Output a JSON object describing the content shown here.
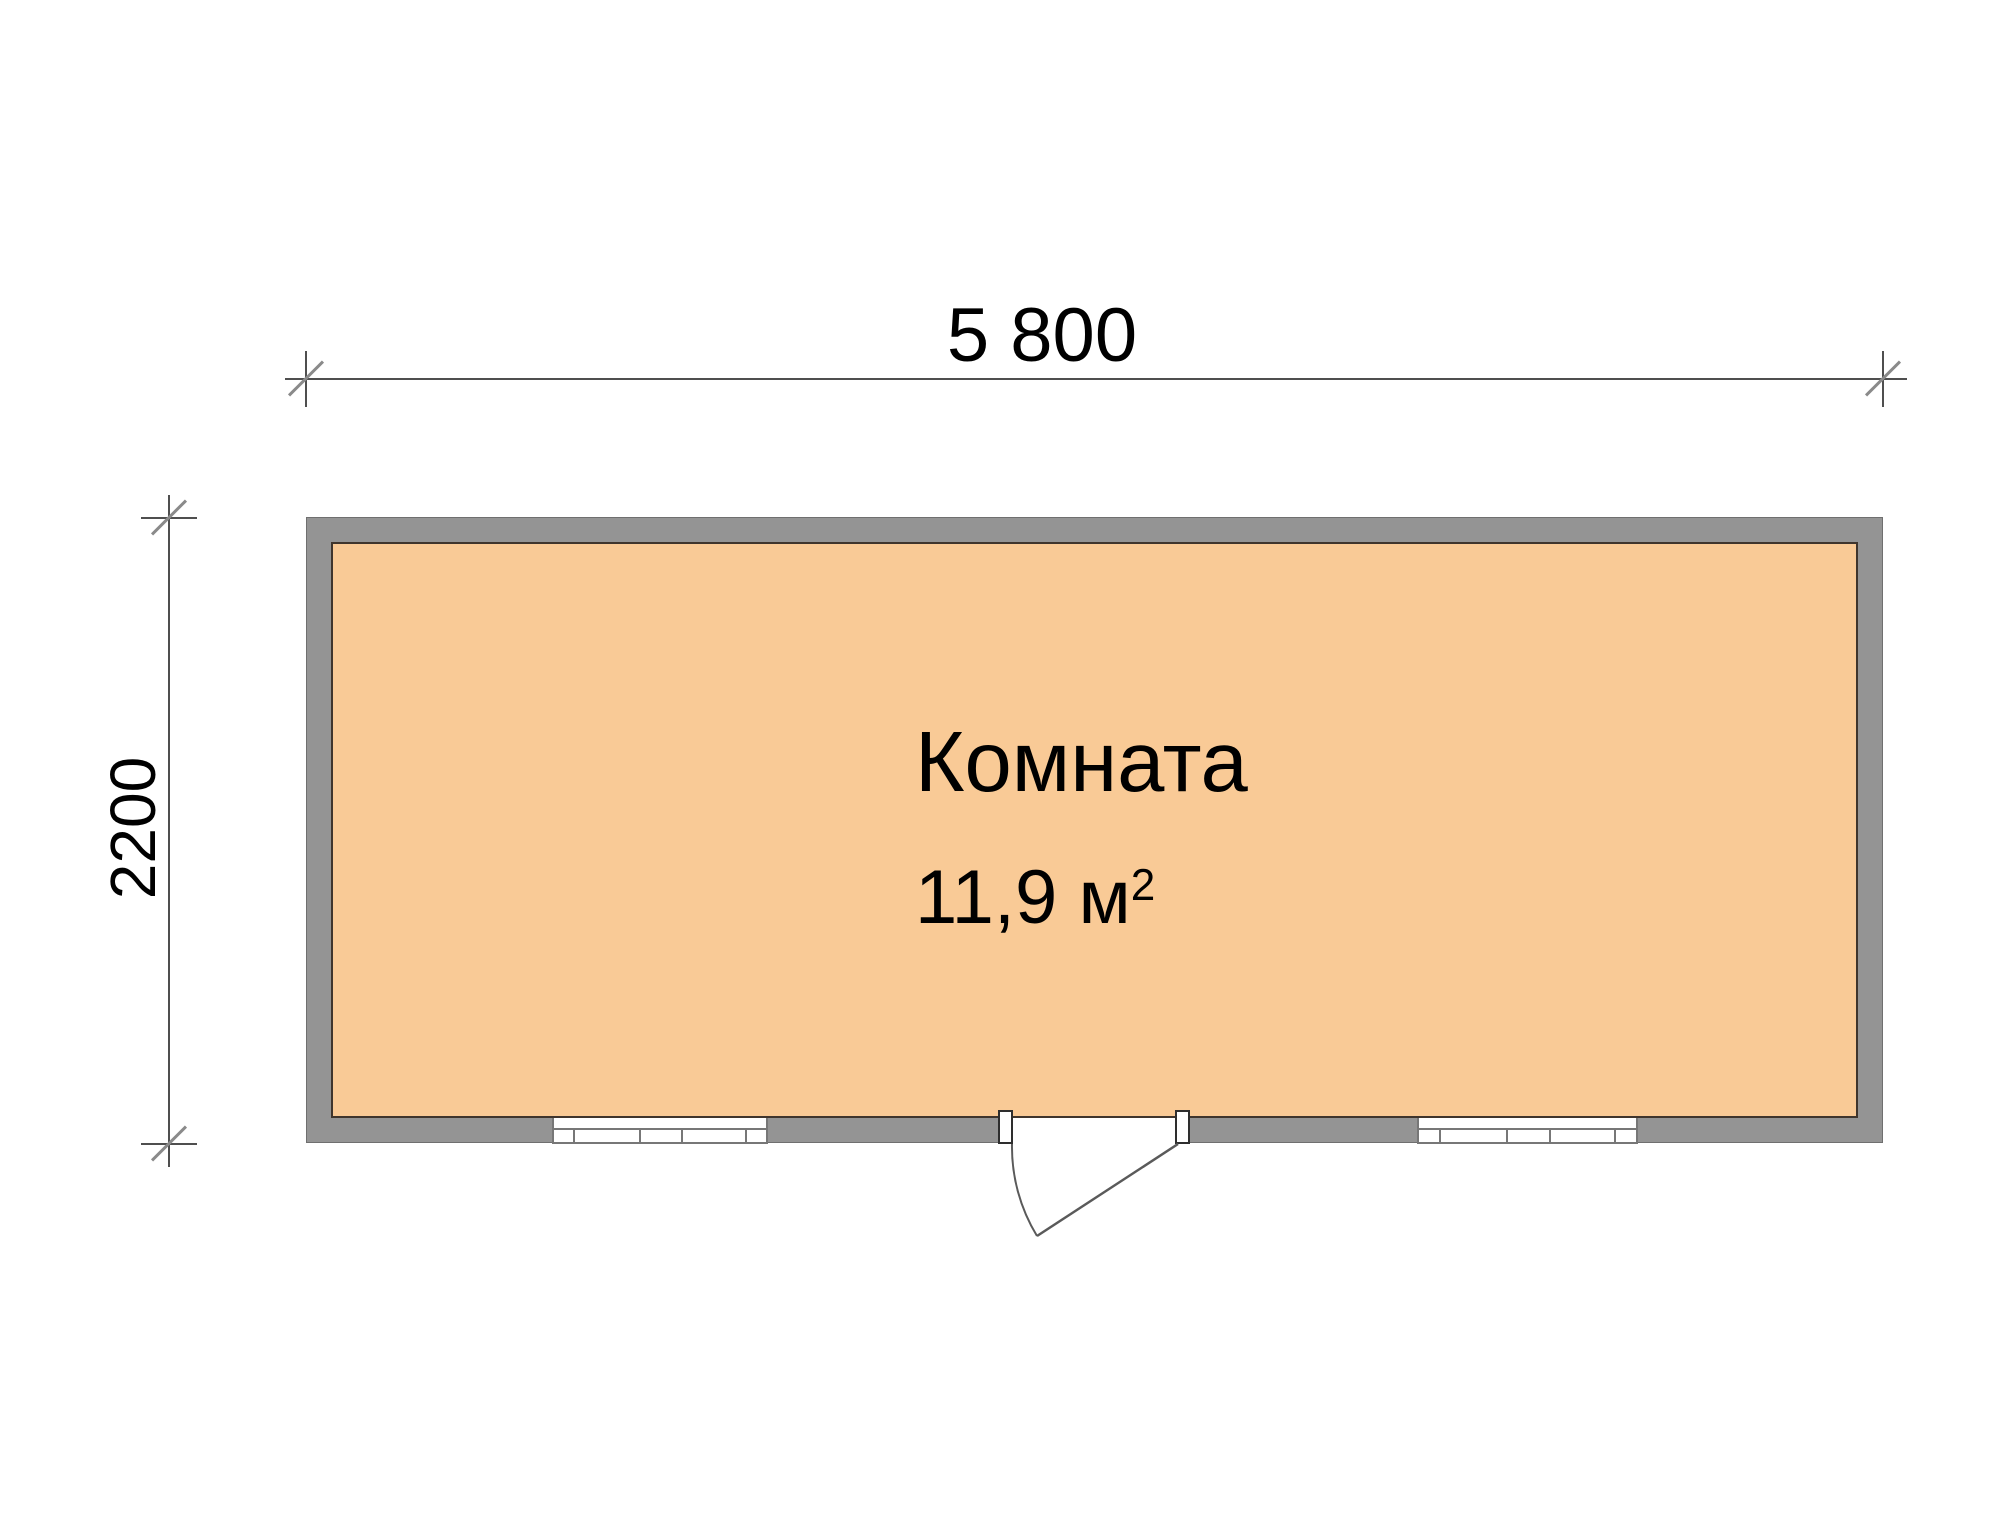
{
  "drawing": {
    "kind": "floor-plan"
  },
  "dimensions": {
    "width_label": "5 800",
    "height_label": "2200"
  },
  "room": {
    "name": "Комната",
    "area_value": "11,9",
    "area_unit": "м",
    "area_exponent": "2"
  },
  "colors": {
    "background": "#ffffff",
    "wall_fill": "#949494",
    "wall_outline": "#6f6f6f",
    "floor_fill": "#f9ca96",
    "floor_outline": "#3f352d",
    "window_line": "#777777",
    "door_jamb_outline": "#2e2e2e",
    "dimension_line": "#4f4f4f",
    "tick_slash": "#8a8a8a",
    "door_swing_line": "#5a5a5a",
    "label_text": "#000000"
  }
}
